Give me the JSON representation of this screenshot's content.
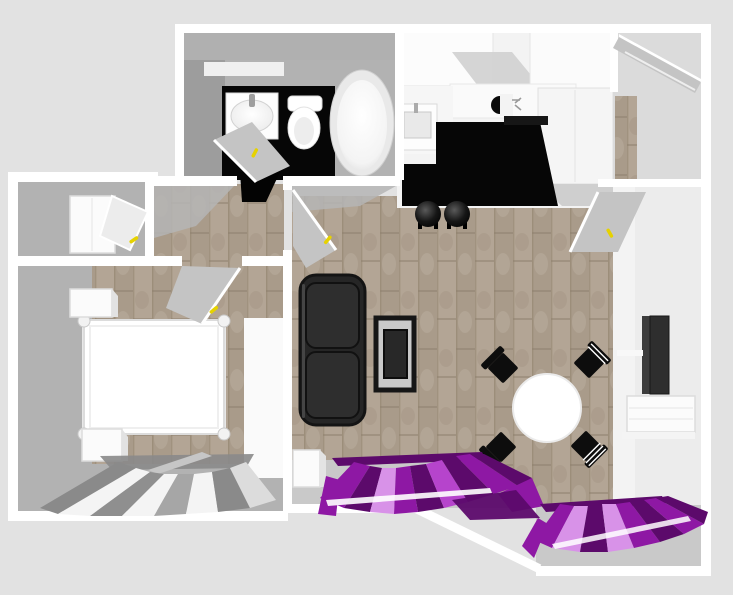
{
  "scene": {
    "type": "3d-floorplan-top-down-render",
    "colors": {
      "background": "#e2e2e2",
      "wall": "#ffffff",
      "room_gray": "#b2b2b2",
      "floor_gray": "#c9c9c9",
      "entry_floor": "#dbdbdb",
      "carpet_base": "#b3a595",
      "carpet_alt": "#a99b8a",
      "dark_floor": "#060606",
      "furniture_black": "#0d0d0d",
      "sofa": "#262626",
      "white_furniture": "#fbfbfb",
      "tv": "#2e2e2e",
      "door_gray": "#c4c4c4",
      "handle_yellow": "#e6d200",
      "curtain_purple_dark": "#5c0a6b",
      "curtain_purple": "#8e18a4",
      "curtain_purple_light": "#d892e8",
      "curtain_silver_dark": "#8a8a8a",
      "curtain_silver_light": "#f4f4f4"
    },
    "rooms": [
      {
        "id": "bathroom",
        "furniture": [
          "wall-shelf",
          "washbasin",
          "toilet",
          "bathtub",
          "open-door"
        ]
      },
      {
        "id": "kitchen",
        "furniture": [
          "upper-cabinets",
          "kitchen-sink",
          "cooktop",
          "tall-cabinet",
          "bar-stool",
          "bar-stool"
        ]
      },
      {
        "id": "entry-hall",
        "furniture": [
          "front-door",
          "inner-door"
        ]
      },
      {
        "id": "closet-room",
        "furniture": [
          "wardrobe",
          "open-door"
        ]
      },
      {
        "id": "hallway",
        "furniture": [
          "open-door"
        ]
      },
      {
        "id": "bedroom",
        "furniture": [
          "four-poster-bed",
          "nightstand",
          "nightstand",
          "silver-curtains",
          "open-door"
        ]
      },
      {
        "id": "living-dining-room",
        "furniture": [
          "sofa",
          "side-cabinet",
          "coffee-table",
          "round-dining-table",
          "dining-chair",
          "dining-chair",
          "dining-chair",
          "dining-chair",
          "tv",
          "tv-stand",
          "purple-curtains",
          "purple-curtains"
        ]
      }
    ]
  }
}
